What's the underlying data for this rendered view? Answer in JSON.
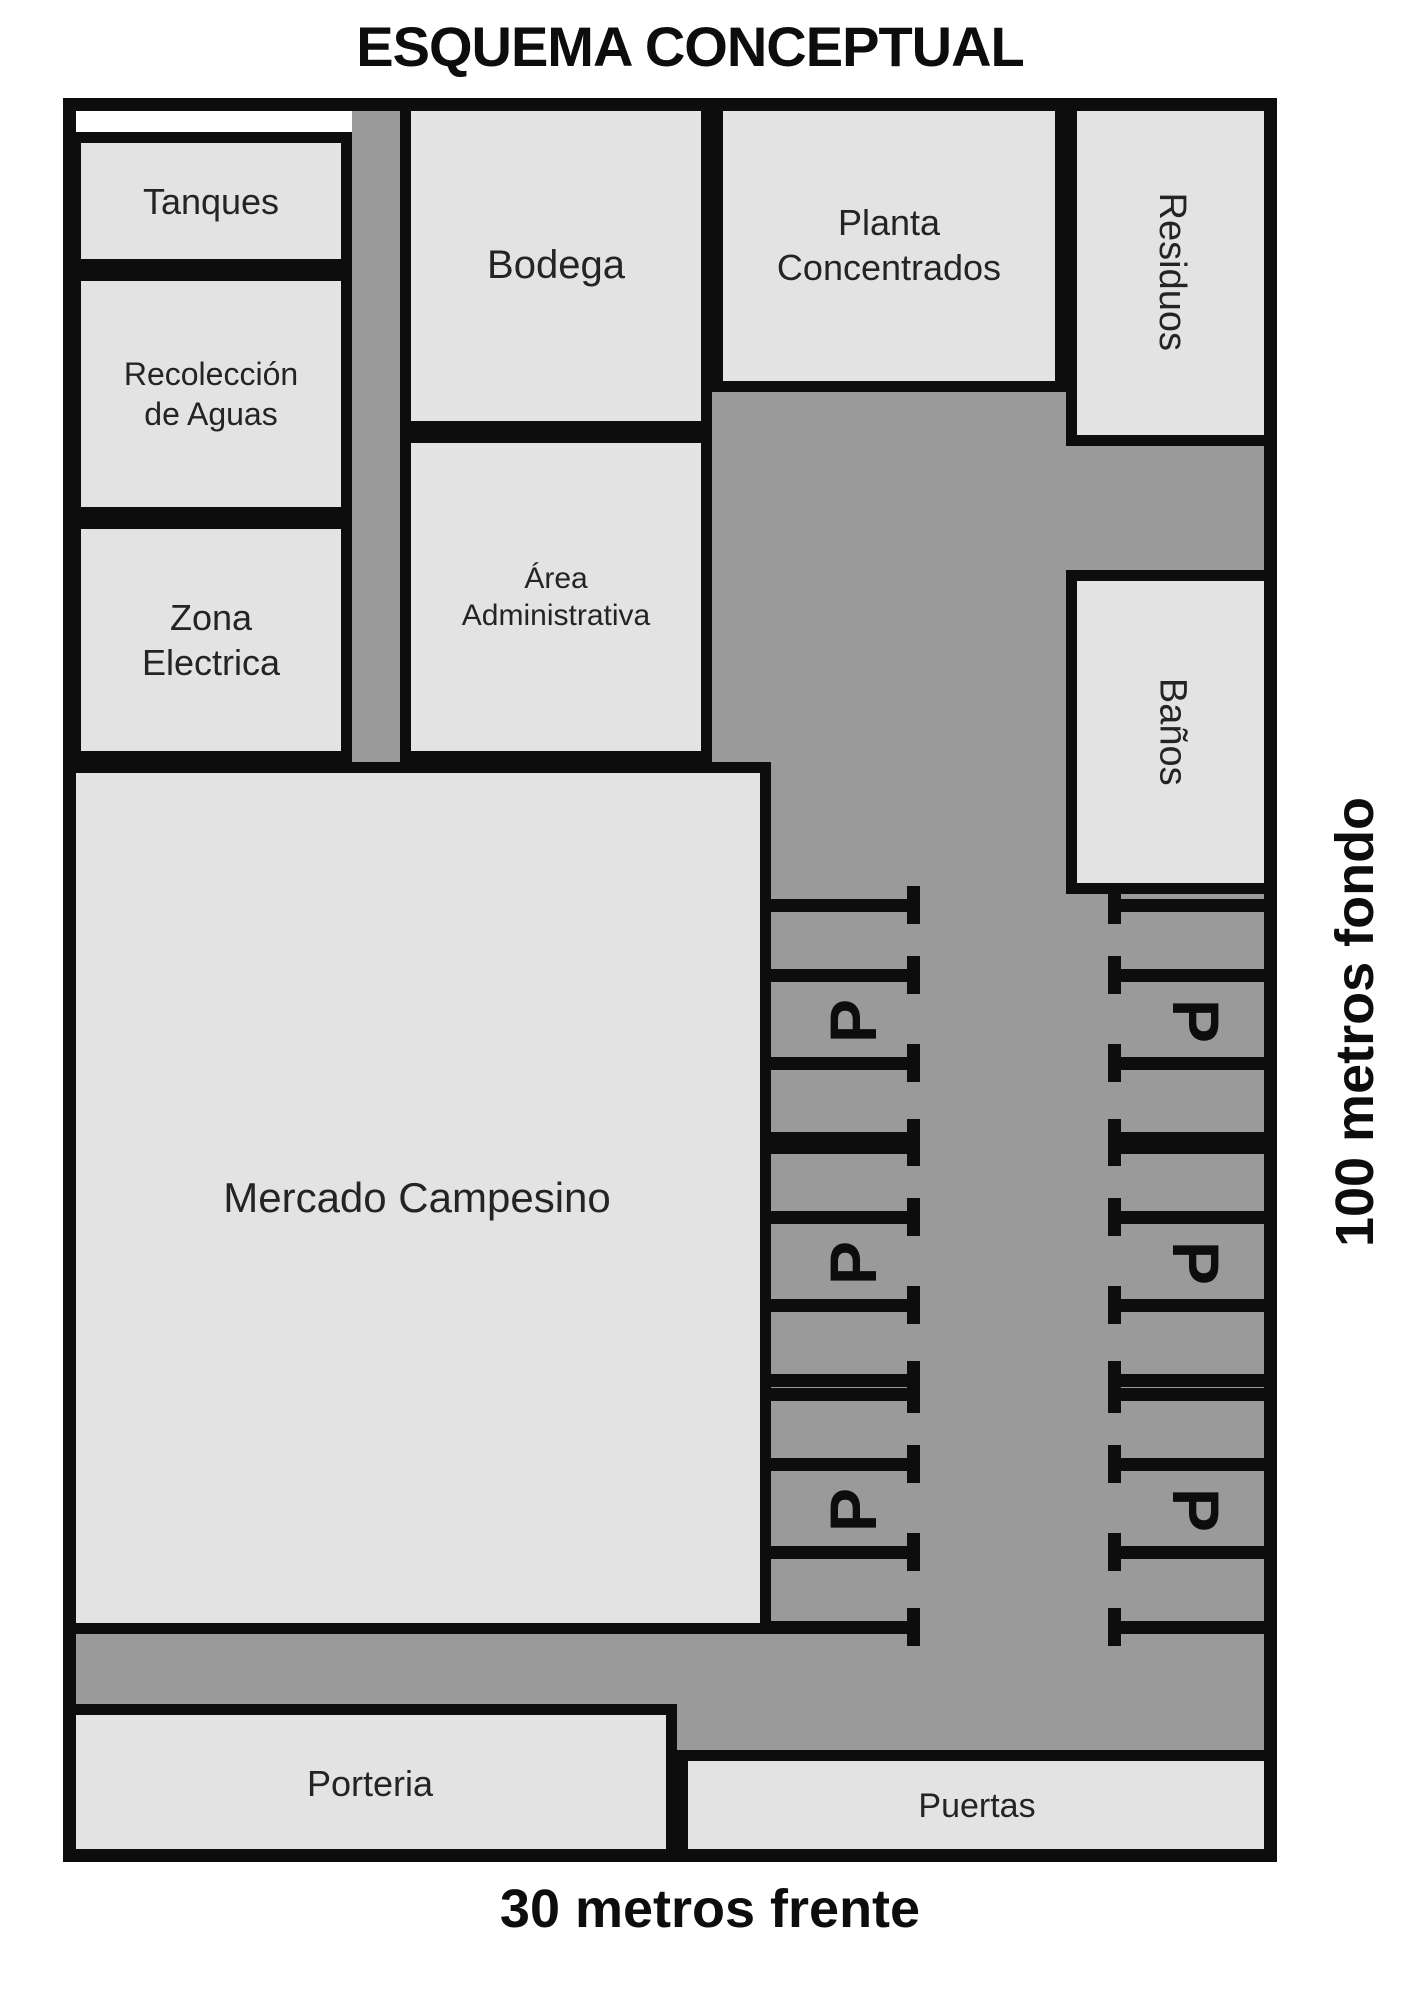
{
  "title": "ESQUEMA CONCEPTUAL",
  "rooms": {
    "tanques": {
      "label": "Tanques"
    },
    "recoleccion": {
      "label": "Recolección de Aguas"
    },
    "zona_electrica": {
      "label": "Zona Electrica"
    },
    "bodega": {
      "label": "Bodega"
    },
    "area_administrativa": {
      "label": "Área Administrativa"
    },
    "planta_concentrados": {
      "label": "Planta Concentrados"
    },
    "residuos": {
      "label": "Residuos"
    },
    "banos": {
      "label": "Baños"
    },
    "mercado": {
      "label": "Mercado Campesino"
    },
    "porteria": {
      "label": "Porteria"
    },
    "puertas": {
      "label": "Puertas"
    }
  },
  "dimensions": {
    "depth": "100 metros fondo",
    "front": "30 metros frente"
  },
  "parking": {
    "p_label": "P",
    "line_rows_y": [
      905,
      975,
      1063,
      1138,
      1147,
      1217,
      1305,
      1380,
      1394,
      1464,
      1552,
      1627
    ],
    "p_rows_y": [
      1021,
      1263,
      1510
    ],
    "middle_column": {
      "line_x": 771,
      "line_w": 149,
      "tick_x": 907,
      "p_x": 853,
      "p_rotation": "ccw"
    },
    "right_column": {
      "line_x": 1108,
      "line_w": 156,
      "tick_x": 1108,
      "p_x": 1196,
      "p_rotation": "cw"
    },
    "line_thickness": 13,
    "tick_height": 38
  },
  "colors": {
    "room_fill": "#e3e3e3",
    "road": "#9a9a9a",
    "line_black": "#0d0d0d",
    "background": "#ffffff"
  }
}
